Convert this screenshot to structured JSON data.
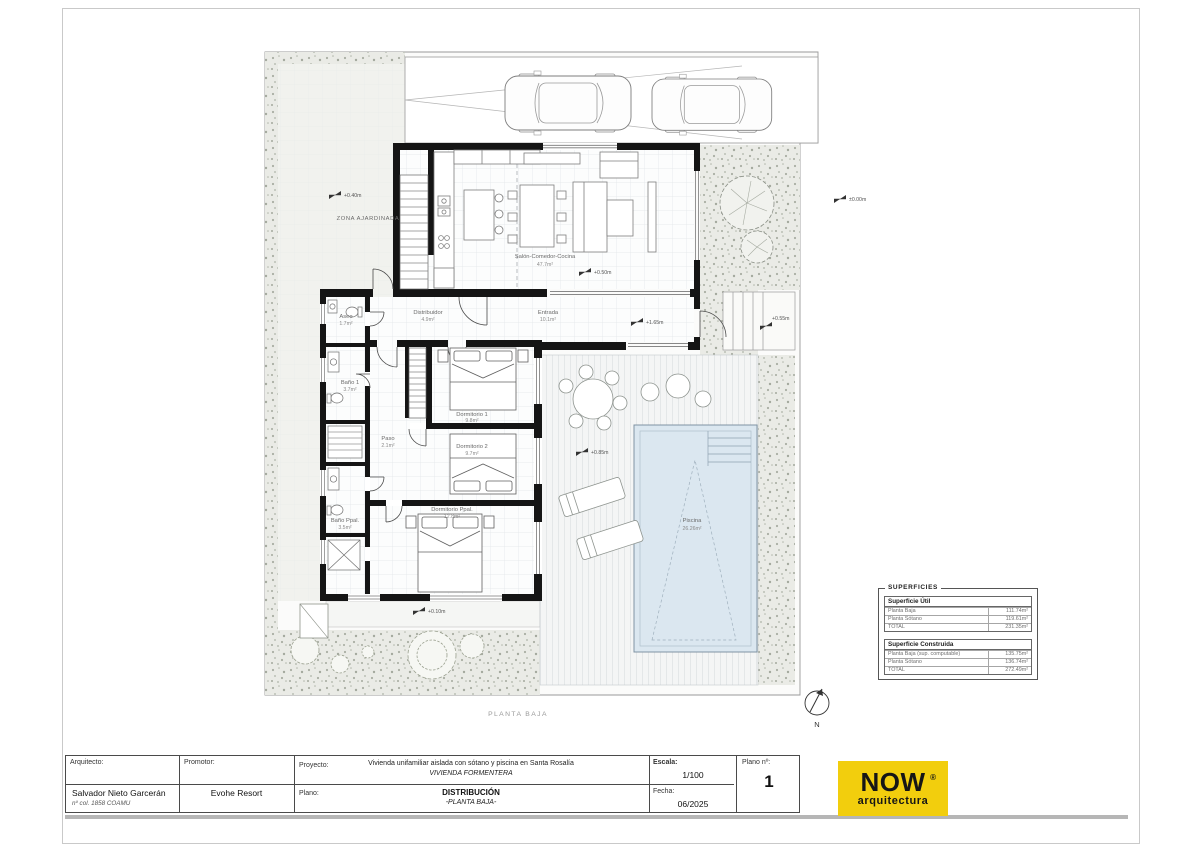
{
  "sheet": {
    "caption": "PLANTA BAJA"
  },
  "plan": {
    "north_label": "N",
    "rooms": {
      "garden": {
        "name": "ZONA AJARDINADA"
      },
      "living": {
        "name": "Salón-Comedor-Cocina",
        "area": "47.7m²"
      },
      "distribuidor": {
        "name": "Distribuidor",
        "area": "4.9m²"
      },
      "entrada": {
        "name": "Entrada",
        "area": "10.1m²"
      },
      "aseo": {
        "name": "Aseo",
        "area": "1.7m²"
      },
      "bano1": {
        "name": "Baño 1",
        "area": "3.7m²"
      },
      "paso": {
        "name": "Paso",
        "area": "2.1m²"
      },
      "dormitorio1": {
        "name": "Dormitorio 1",
        "area": "9.8m²"
      },
      "dormitorio2": {
        "name": "Dormitorio 2",
        "area": "9.7m²"
      },
      "bano_ppal": {
        "name": "Baño Ppal.",
        "area": "3.5m²"
      },
      "dormitorio_ppal": {
        "name": "Dormitorio Ppal.",
        "area": "12.8m²"
      },
      "piscina": {
        "name": "Piscina",
        "area": "26.26m²"
      }
    },
    "levels": {
      "garden": "+0.40m",
      "living": "+0.50m",
      "entrada": "+1.65m",
      "terrace": "+0.85m",
      "entry_steps": "+0.55m",
      "walkway": "+0.10m",
      "street": "±0.00m"
    }
  },
  "superficies": {
    "title": "SUPERFICIES",
    "util": {
      "header": "Superficie Útil",
      "rows": [
        {
          "label": "Planta Baja",
          "value": "111.74m²"
        },
        {
          "label": "Planta Sótano",
          "value": "119.61m²"
        },
        {
          "label": "TOTAL",
          "value": "231.35m²"
        }
      ]
    },
    "construida": {
      "header": "Superficie Construida",
      "rows": [
        {
          "label": "Planta Baja (sup. computable)",
          "value": "135.75m²"
        },
        {
          "label": "Planta Sótano",
          "value": "136.74m²"
        },
        {
          "label": "TOTAL",
          "value": "272.49m²"
        }
      ]
    }
  },
  "titleblock": {
    "arquitecto_label": "Arquitecto:",
    "arquitecto_name": "Salvador Nieto Garcerán",
    "arquitecto_col": "nº col. 1858 COAMU",
    "promotor_label": "Promotor:",
    "promotor_name": "Evohe Resort",
    "proyecto_label": "Proyecto:",
    "proyecto_line1": "Vivienda unifamiliar aislada con sótano y piscina en Santa Rosalía",
    "proyecto_line2": "VIVIENDA FORMENTERA",
    "plano_label": "Plano:",
    "plano_line1": "DISTRIBUCIÓN",
    "plano_line2": "-PLANTA BAJA-",
    "escala_label": "Escala:",
    "escala_value": "1/100",
    "fecha_label": "Fecha:",
    "fecha_value": "06/2025",
    "plano_num_label": "Plano nº:",
    "plano_num_value": "1"
  },
  "logo": {
    "word": "NOW",
    "registered": "®",
    "subtitle": "arquitectura",
    "bg_color": "#F2CE0D",
    "text_color": "#161616"
  }
}
